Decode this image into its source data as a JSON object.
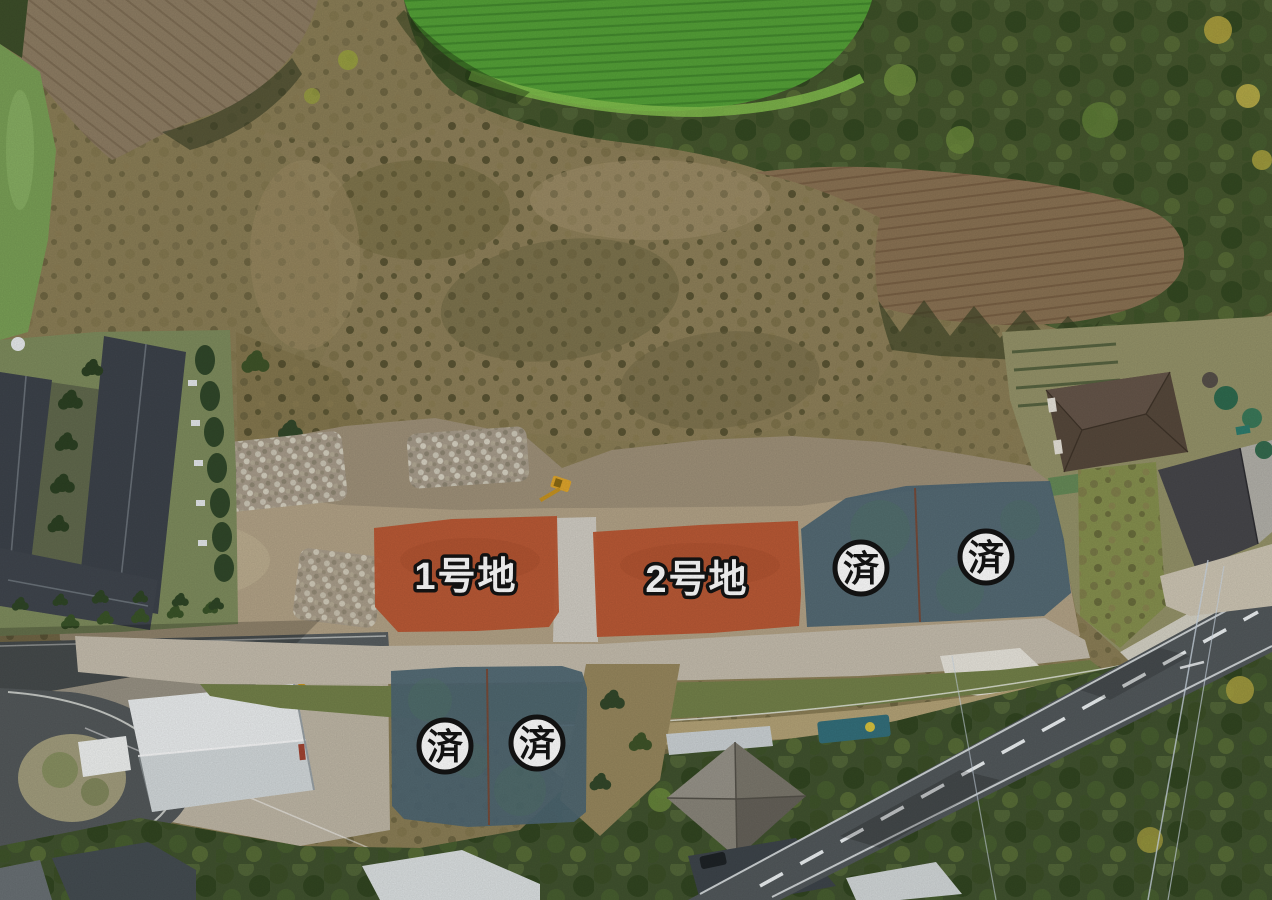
{
  "scene": {
    "kind": "aerial-subdivision-photo",
    "description": "Drone aerial photo of a residential land subdivision with lot-status overlays"
  },
  "colors": {
    "available_overlay": "#bc5632",
    "sold_overlay": "#4d6673",
    "badge_background": "#ffffff",
    "badge_border": "#141414",
    "badge_text_color": "#141414",
    "label_text": "#ffffff",
    "label_outline": "#141414",
    "parcel_divider": "#7e4630"
  },
  "lots": [
    {
      "label": "1号地"
    },
    {
      "label": "2号地"
    },
    {
      "label": "済"
    },
    {
      "label": "済"
    },
    {
      "label": "済"
    },
    {
      "label": "済"
    }
  ]
}
